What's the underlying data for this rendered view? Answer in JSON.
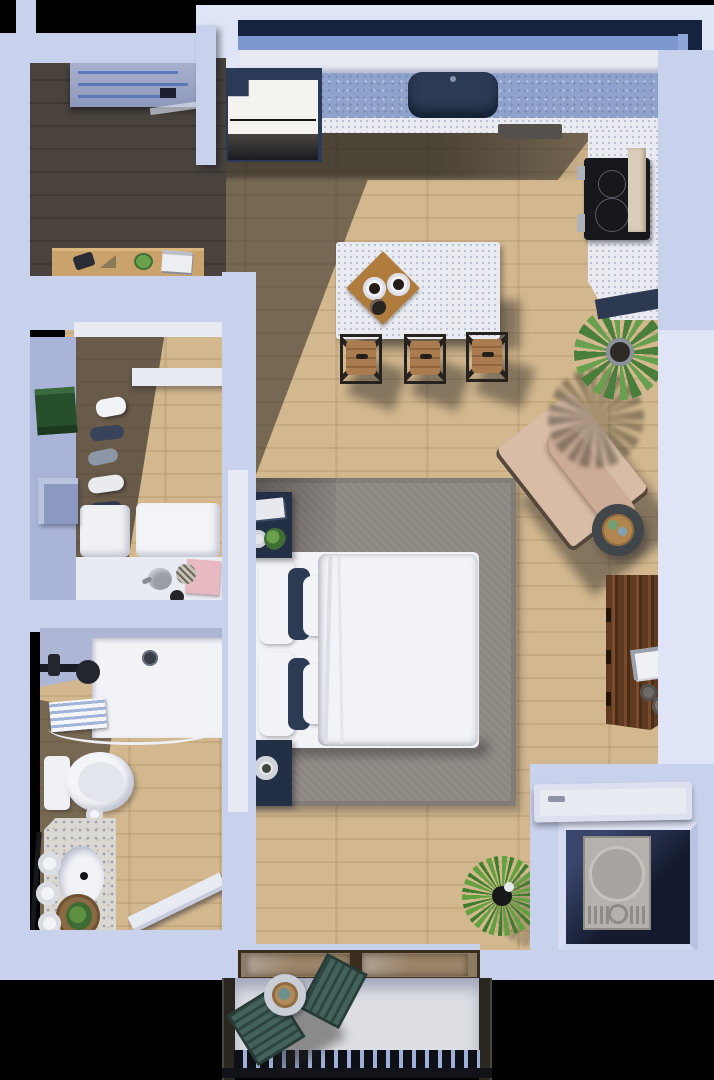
{
  "scene": {
    "kind": "3d-floor-plan-render",
    "view": "top-down",
    "description": "Studio apartment 3D floor plan with kitchen, living/bedroom area, walk-in closet, bathroom, laundry closet and balcony",
    "background": "#000000"
  },
  "palette": {
    "wall": "#c9d2ed",
    "wallLight": "#dfe5f6",
    "wallShade": "#aab4d8",
    "wallDark": "#8e9cc7",
    "winFrame": "#16233f",
    "winGlass": "#7e97cf",
    "winGlass2": "#8fa5d8",
    "counterBlue": "#8fa2cb",
    "counterWhite": "#e9ebf1",
    "sinkNavy": "#2c3b55",
    "woodLight": "#d3b88f",
    "woodDark": "#49423c",
    "rug": "#8d8782",
    "bedding": "#f2f3f6",
    "navy": "#232f45",
    "stoolWood": "#aa7c4f",
    "chairBeige": "#d9bca6",
    "dresserWood": "#5d3a20",
    "plant": "#4a7f3b",
    "teal": "#3e5b55",
    "washer": "#b5b1ac",
    "terrazzo": "#dbd8d1",
    "balconyFloor": "#dcdee3",
    "railing": "#221f1b",
    "doorWhite": "#e9ebf3",
    "glassDoor": "#806a52",
    "bg": "#000000"
  },
  "rooms": [
    {
      "id": "entry",
      "name": "Entry hall with front door and desk"
    },
    {
      "id": "kitchen",
      "name": "Kitchen with L-counter, sink, fridge, cooktop and island with 3 stools"
    },
    {
      "id": "living-bedroom",
      "name": "Combined living/bedroom with queen bed, rug, armchair, dresser and mirror"
    },
    {
      "id": "closet",
      "name": "Walk-in closet with hanging clothes, shelves and storage"
    },
    {
      "id": "bathroom",
      "name": "Bathroom with walk-in shower, toilet and terrazzo vanity"
    },
    {
      "id": "laundry",
      "name": "Laundry closet with washer/dryer"
    },
    {
      "id": "balcony",
      "name": "Balcony with two slatted chairs, side table and railing"
    }
  ],
  "furniture": [
    "front-door",
    "entry-desk",
    "fridge",
    "kitchen-sink",
    "kitchen-counter",
    "cooktop",
    "kitchen-island",
    "cutting-board",
    "bar-stool",
    "bed",
    "pillows",
    "duvet",
    "nightstand",
    "area-rug",
    "armchair",
    "side-table",
    "potted-plant-leafy",
    "potted-plant-spiky",
    "dresser",
    "leaning-mirror",
    "washer-dryer",
    "laundry-door",
    "sliding-glass-door",
    "toilet",
    "shower",
    "shower-towel",
    "vanity",
    "bathroom-door",
    "hanging-clothes",
    "closet-shelf",
    "storage-boxes",
    "tea-tray",
    "green-towel",
    "storage-box-blue",
    "balcony-chair",
    "balcony-table",
    "balcony-railing"
  ]
}
